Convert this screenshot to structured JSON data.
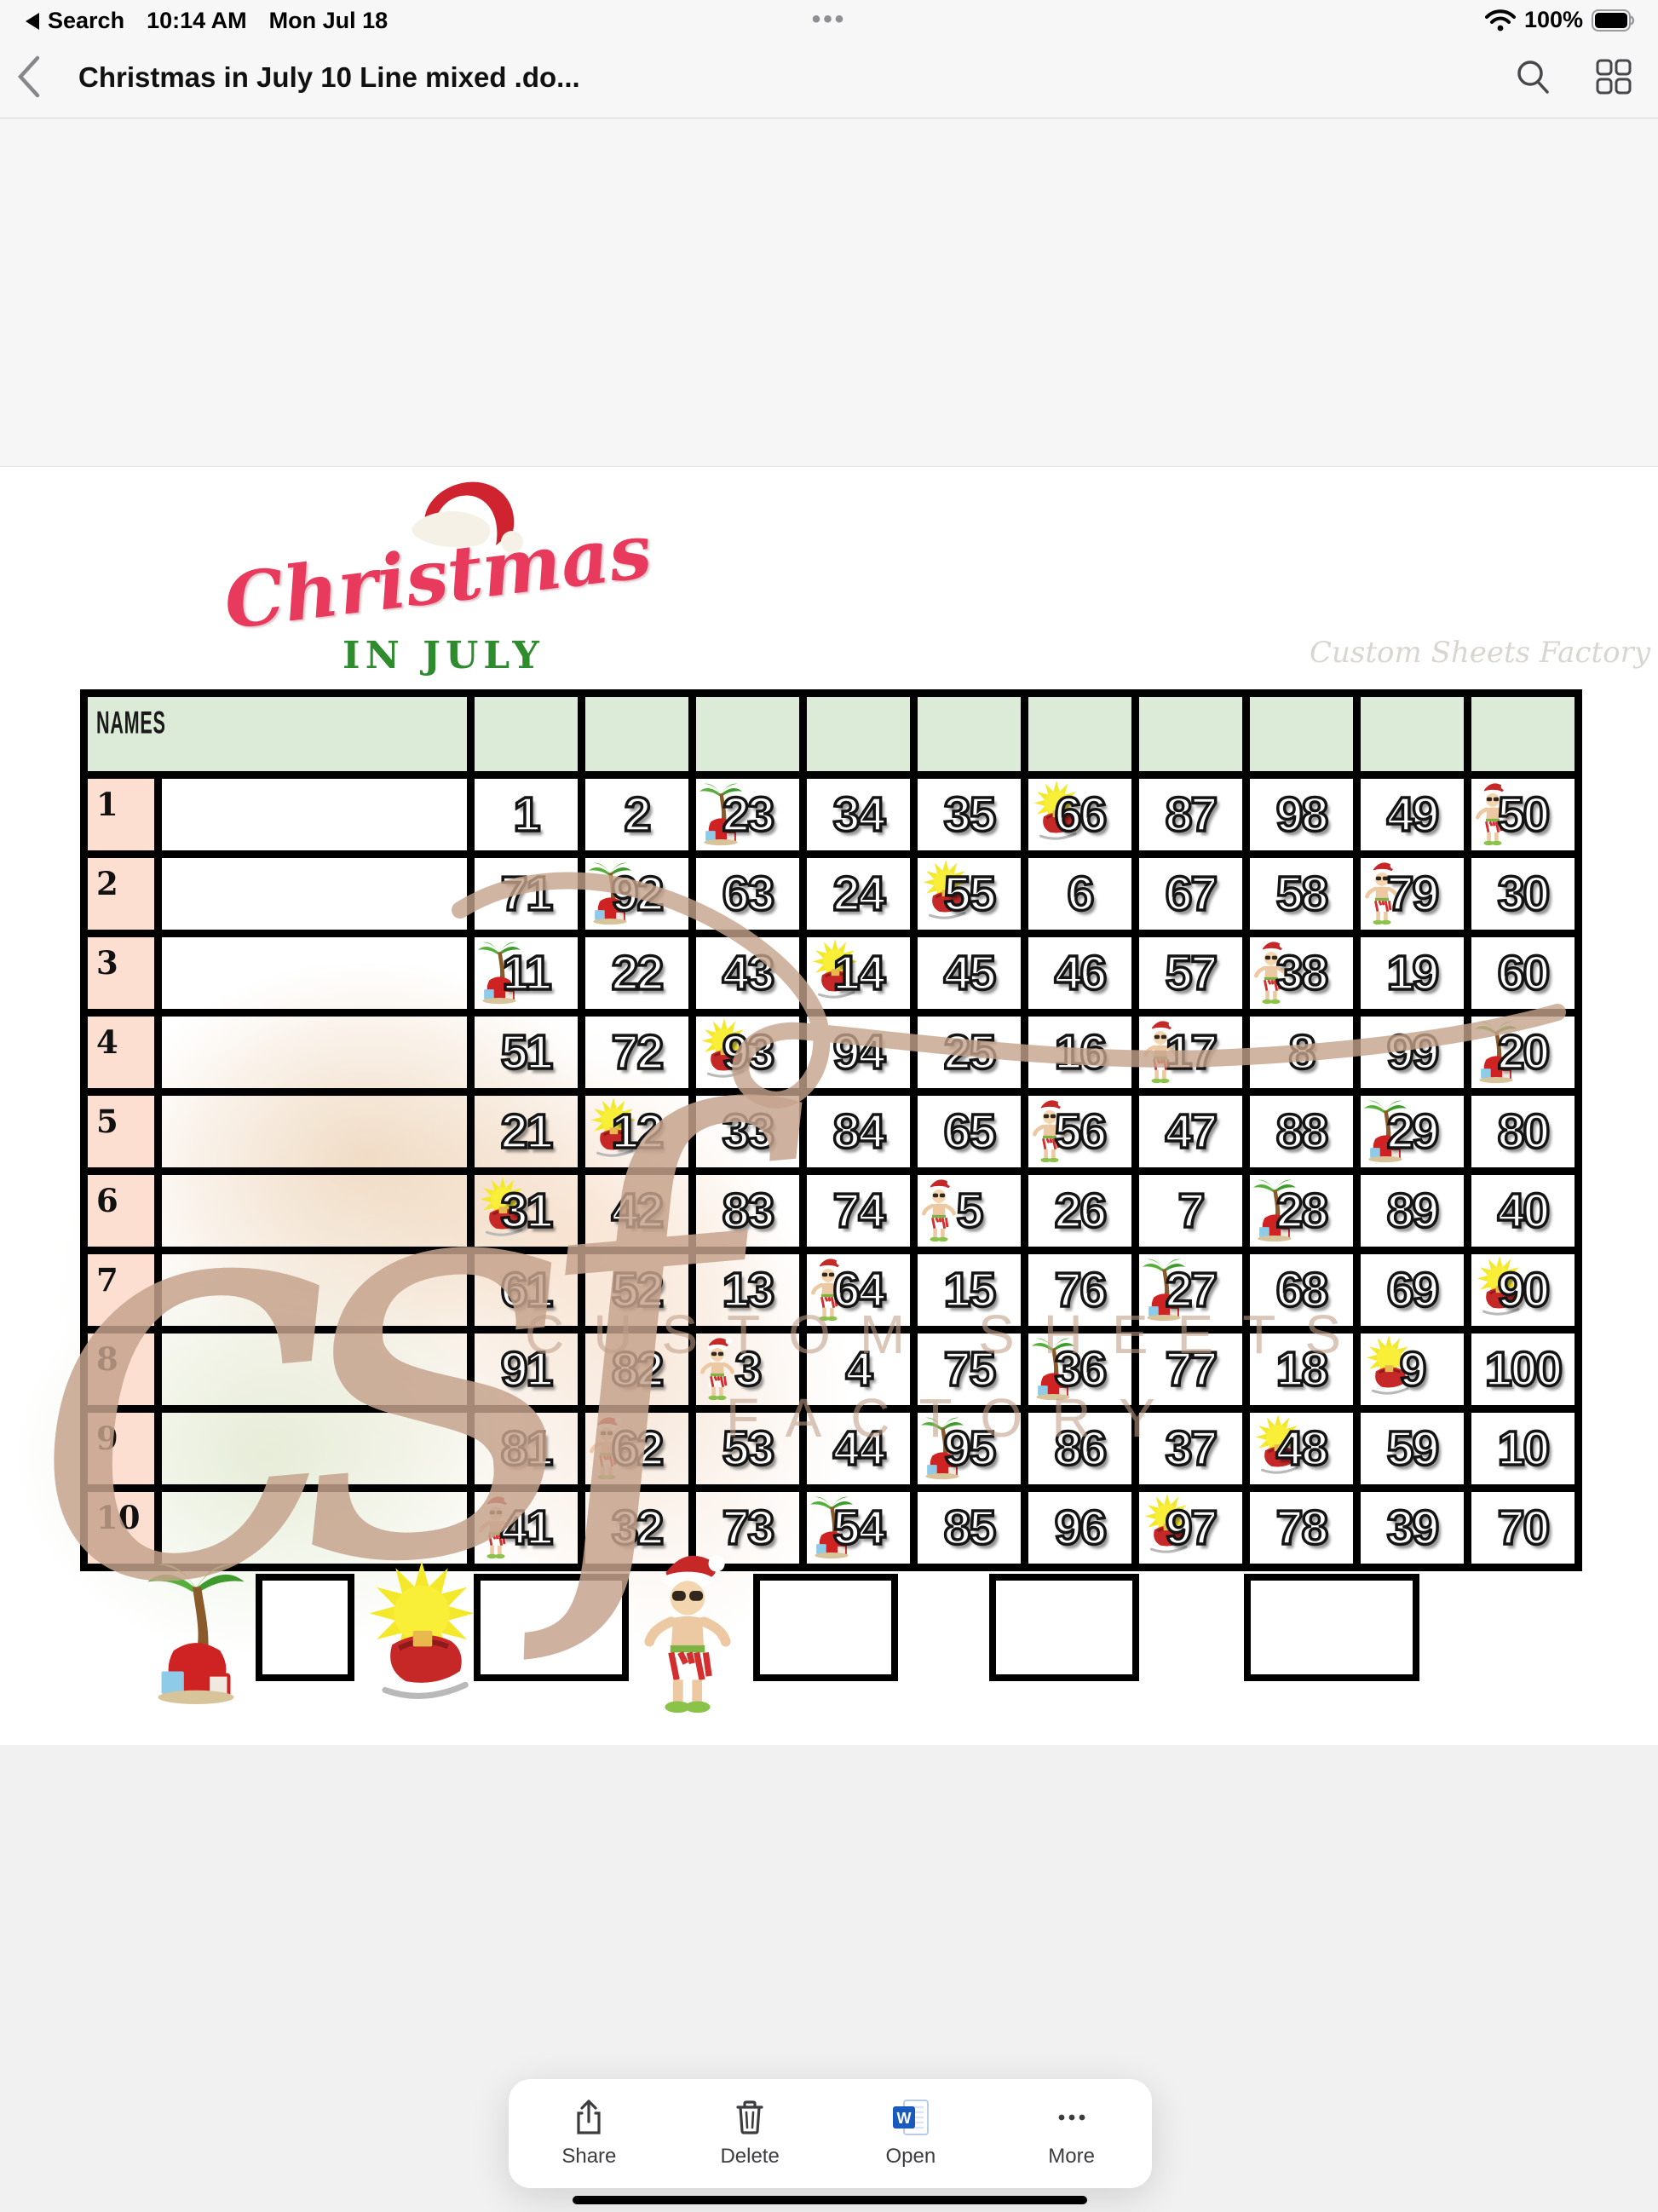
{
  "status_bar": {
    "back": "Search",
    "time": "10:14 AM",
    "date": "Mon Jul 18",
    "center_dots": "•••",
    "battery": "100%"
  },
  "nav_bar": {
    "title": "Christmas in July 10 Line mixed .do..."
  },
  "page": {
    "logo": {
      "title": "Christmas",
      "subtitle": "IN JULY"
    },
    "brand_small": "Custom Sheets Factory",
    "watermark": {
      "script": "csf",
      "line1": "CUSTOM SHEETS",
      "line2": "FACTORY"
    },
    "grid": {
      "names_header": "NAMES",
      "rows": [
        {
          "line": "1",
          "cells": [
            {
              "n": "1"
            },
            {
              "n": "2"
            },
            {
              "n": "23",
              "icon": "palm-tree"
            },
            {
              "n": "34"
            },
            {
              "n": "35"
            },
            {
              "n": "66",
              "icon": "sun-sleigh"
            },
            {
              "n": "87"
            },
            {
              "n": "98"
            },
            {
              "n": "49"
            },
            {
              "n": "50",
              "icon": "santa"
            }
          ]
        },
        {
          "line": "2",
          "cells": [
            {
              "n": "71"
            },
            {
              "n": "92",
              "icon": "palm-tree"
            },
            {
              "n": "63"
            },
            {
              "n": "24"
            },
            {
              "n": "55",
              "icon": "sun-sleigh"
            },
            {
              "n": "6"
            },
            {
              "n": "67"
            },
            {
              "n": "58"
            },
            {
              "n": "79",
              "icon": "santa"
            },
            {
              "n": "30"
            }
          ]
        },
        {
          "line": "3",
          "cells": [
            {
              "n": "11",
              "icon": "palm-tree"
            },
            {
              "n": "22"
            },
            {
              "n": "43"
            },
            {
              "n": "14",
              "icon": "sun-sleigh"
            },
            {
              "n": "45"
            },
            {
              "n": "46"
            },
            {
              "n": "57"
            },
            {
              "n": "38",
              "icon": "santa"
            },
            {
              "n": "19"
            },
            {
              "n": "60"
            }
          ]
        },
        {
          "line": "4",
          "cells": [
            {
              "n": "51"
            },
            {
              "n": "72"
            },
            {
              "n": "93",
              "icon": "sun-sleigh"
            },
            {
              "n": "94"
            },
            {
              "n": "25"
            },
            {
              "n": "16"
            },
            {
              "n": "17",
              "icon": "santa"
            },
            {
              "n": "8"
            },
            {
              "n": "99"
            },
            {
              "n": "20",
              "icon": "palm-tree"
            }
          ]
        },
        {
          "line": "5",
          "cells": [
            {
              "n": "21"
            },
            {
              "n": "12",
              "icon": "sun-sleigh"
            },
            {
              "n": "33"
            },
            {
              "n": "84"
            },
            {
              "n": "65"
            },
            {
              "n": "56",
              "icon": "santa"
            },
            {
              "n": "47"
            },
            {
              "n": "88"
            },
            {
              "n": "29",
              "icon": "palm-tree"
            },
            {
              "n": "80"
            }
          ]
        },
        {
          "line": "6",
          "cells": [
            {
              "n": "31",
              "icon": "sun-sleigh"
            },
            {
              "n": "42"
            },
            {
              "n": "83"
            },
            {
              "n": "74"
            },
            {
              "n": "5",
              "icon": "santa"
            },
            {
              "n": "26"
            },
            {
              "n": "7"
            },
            {
              "n": "28",
              "icon": "palm-tree"
            },
            {
              "n": "89"
            },
            {
              "n": "40"
            }
          ]
        },
        {
          "line": "7",
          "cells": [
            {
              "n": "61"
            },
            {
              "n": "52"
            },
            {
              "n": "13"
            },
            {
              "n": "64",
              "icon": "santa"
            },
            {
              "n": "15"
            },
            {
              "n": "76"
            },
            {
              "n": "27",
              "icon": "palm-tree"
            },
            {
              "n": "68"
            },
            {
              "n": "69"
            },
            {
              "n": "90",
              "icon": "sun-sleigh"
            }
          ]
        },
        {
          "line": "8",
          "cells": [
            {
              "n": "91"
            },
            {
              "n": "82"
            },
            {
              "n": "3",
              "icon": "santa"
            },
            {
              "n": "4"
            },
            {
              "n": "75"
            },
            {
              "n": "36",
              "icon": "palm-tree"
            },
            {
              "n": "77"
            },
            {
              "n": "18"
            },
            {
              "n": "9",
              "icon": "sun-sleigh"
            },
            {
              "n": "100"
            }
          ]
        },
        {
          "line": "9",
          "cells": [
            {
              "n": "81"
            },
            {
              "n": "62",
              "icon": "santa"
            },
            {
              "n": "53"
            },
            {
              "n": "44"
            },
            {
              "n": "95",
              "icon": "palm-tree"
            },
            {
              "n": "86"
            },
            {
              "n": "37"
            },
            {
              "n": "48",
              "icon": "sun-sleigh"
            },
            {
              "n": "59"
            },
            {
              "n": "10"
            }
          ]
        },
        {
          "line": "10",
          "cells": [
            {
              "n": "41",
              "icon": "santa"
            },
            {
              "n": "32"
            },
            {
              "n": "73"
            },
            {
              "n": "54",
              "icon": "palm-tree"
            },
            {
              "n": "85"
            },
            {
              "n": "96"
            },
            {
              "n": "97",
              "icon": "sun-sleigh"
            },
            {
              "n": "78"
            },
            {
              "n": "39"
            },
            {
              "n": "70"
            }
          ]
        }
      ]
    },
    "legend": [
      {
        "icon": "palm-tree"
      },
      {
        "icon": "sun-sleigh"
      },
      {
        "icon": "santa"
      },
      {
        "icon": null
      },
      {
        "icon": null
      }
    ]
  },
  "toolbar": {
    "items": [
      {
        "label": "Share",
        "icon": "share"
      },
      {
        "label": "Delete",
        "icon": "trash"
      },
      {
        "label": "Open",
        "icon": "word"
      },
      {
        "label": "More",
        "icon": "more"
      }
    ]
  },
  "colors": {
    "logo_red": "#e73a5c",
    "logo_green": "#2e8b2e",
    "header_green": "#dcead8",
    "row_label_peach": "#fcdfd0",
    "watermark_tan": "#c5a28c"
  }
}
